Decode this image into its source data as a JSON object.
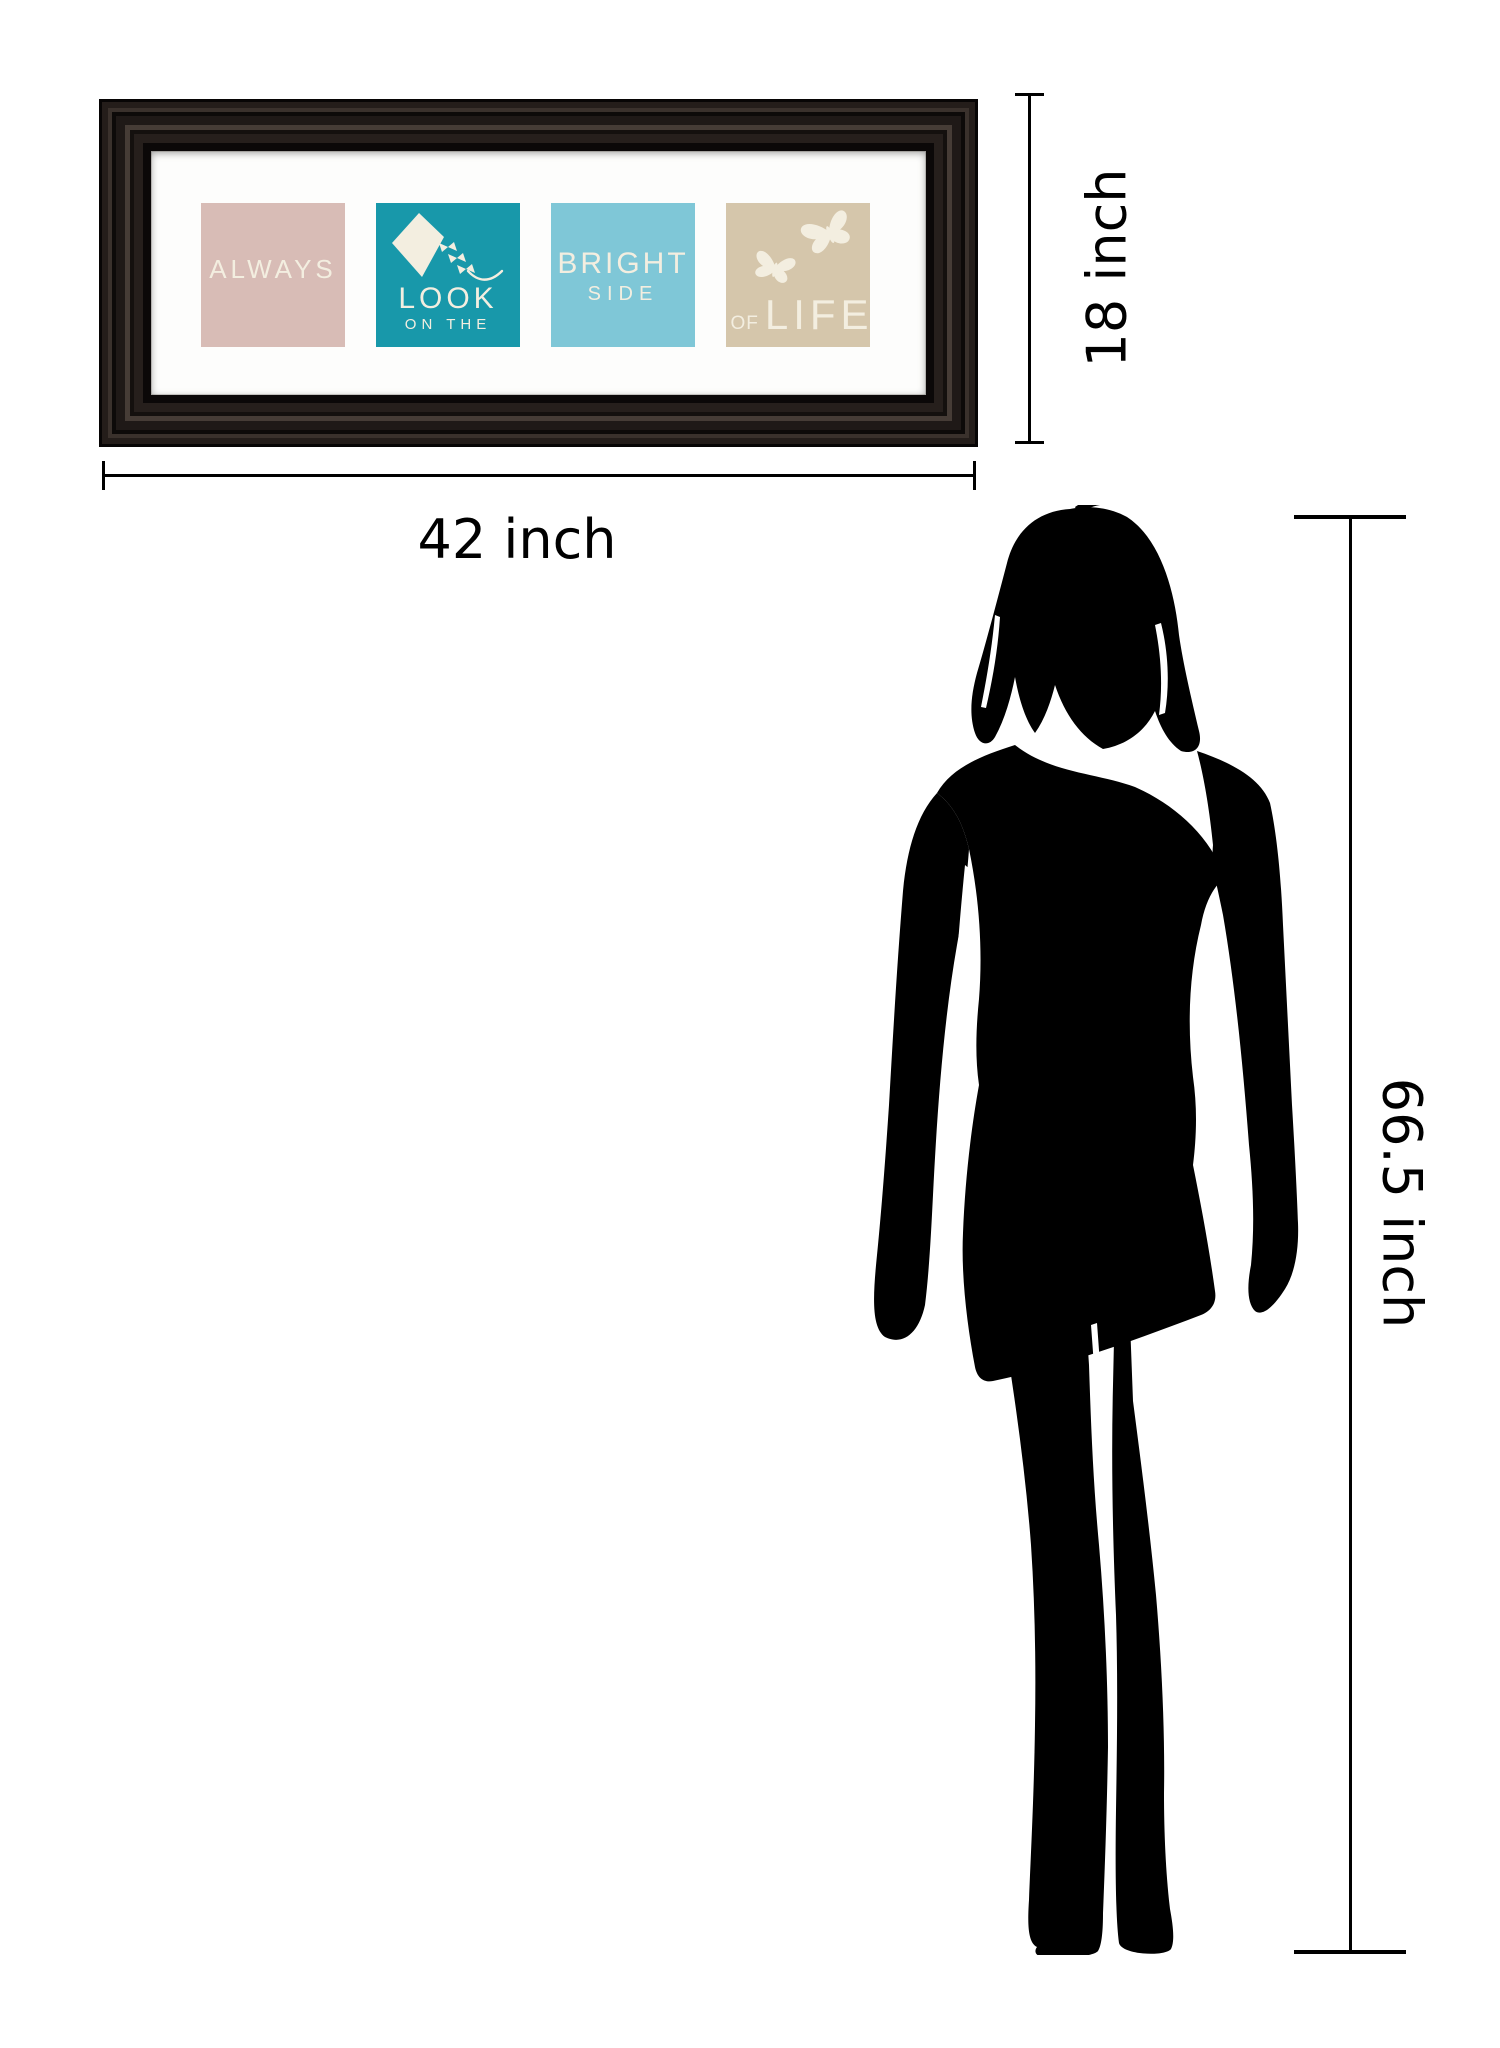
{
  "background": "#ffffff",
  "artwork": {
    "frame_color": "#1a1412",
    "mat_color": "#fdfdfc",
    "panel_text_color": "#f3eee0",
    "panels": [
      {
        "label": "ALWAYS",
        "bg": "#d8bcb6"
      },
      {
        "label": "LOOK",
        "sublabel": "ON THE",
        "bg": "#1898aa",
        "icon": "kite-icon"
      },
      {
        "label": "BRIGHT",
        "sublabel": "SIDE",
        "bg": "#7fc7d7"
      },
      {
        "prefix": "OF",
        "label": "LIFE",
        "bg": "#d5c6ab",
        "icon": "butterflies-icon"
      }
    ]
  },
  "annotations": {
    "line_color": "#000000",
    "width": {
      "label": "42 inch"
    },
    "height": {
      "label": "18 inch"
    },
    "figure_height": {
      "label": "66.5 inch"
    }
  },
  "figure": {
    "type": "woman-silhouette",
    "color": "#000000"
  }
}
